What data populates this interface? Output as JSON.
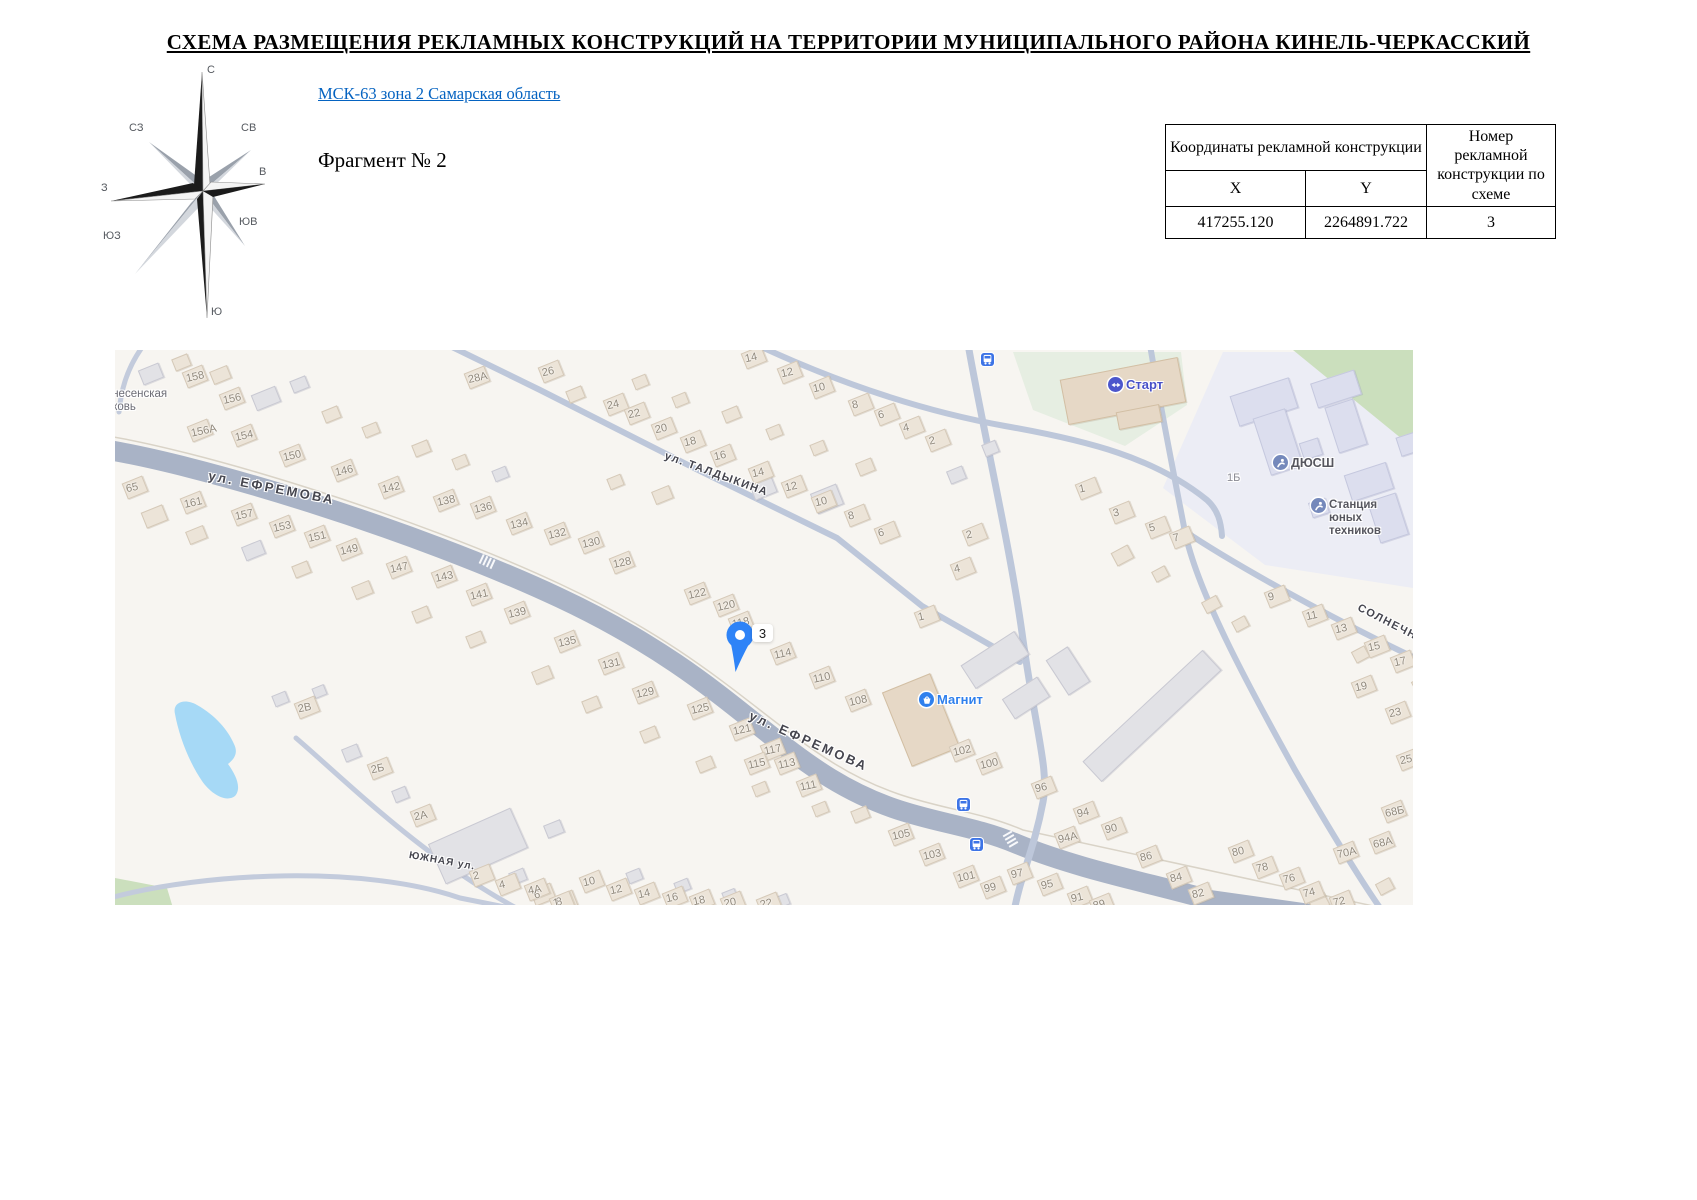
{
  "doc": {
    "title": "СХЕМА РАЗМЕЩЕНИЯ РЕКЛАМНЫХ КОНСТРУКЦИЙ НА ТЕРРИТОРИИ МУНИЦИПАЛЬНОГО РАЙОНА КИНЕЛЬ-ЧЕРКАССКИЙ",
    "link_label": "МСК-63 зона 2 Самарская область",
    "fragment_label": "Фрагмент № 2"
  },
  "compass": {
    "n": "С",
    "ne": "СВ",
    "e": "В",
    "se": "ЮВ",
    "s": "Ю",
    "sw": "ЮЗ",
    "w": "З",
    "nw": "СЗ"
  },
  "table": {
    "coords_header": "Координаты рекламной конструкции",
    "col_x": "X",
    "col_y": "Y",
    "number_header": "Номер рекламной конструкции по схеме",
    "x_value": "417255.120",
    "y_value": "2264891.722",
    "number_value": "3"
  },
  "map": {
    "marker": {
      "label": "3"
    },
    "colors": {
      "road_main": "#a9b3c6",
      "road_minor": "#bdc7da",
      "water": "#a6d9f6",
      "green": "#cbdfbd",
      "lawn": "#e6eee2",
      "campus": "#ecedf5",
      "accent_blue": "#2e83f7"
    },
    "areas": [
      {
        "name": "school-campus-area",
        "path": "M1048,138 L1108,2 L1298,2 L1298,238 L1150,215 Z",
        "color": "#ecedf5"
      },
      {
        "name": "forest-area",
        "path": "M1178,0 L1298,0 L1298,98 Z",
        "color": "#cbdfbd"
      },
      {
        "name": "stadium-lawn",
        "path": "M898,2 L1066,2 L1072,55 L1010,96 L918,60 Z",
        "color": "#e6eee2"
      },
      {
        "name": "green-corner",
        "path": "M0,528 L52,538 L58,558 L0,558 Z",
        "color": "#cbdfbd"
      },
      {
        "name": "pond",
        "path": "M60,364 C57,352 70,348 82,355 C100,365 113,380 119,394 C124,404 118,410 113,414 C121,425 127,438 120,446 C111,453 96,444 87,431 C74,412 64,386 60,364 Z",
        "color": "#a6d9f6"
      }
    ],
    "roads": [
      {
        "name": "field-line-north",
        "path": "M-20,84 C80,98 300,166 445,234 C590,302 645,368 720,414 C795,460 848,454 908,480 L1295,564",
        "width": 1.5,
        "color": "#d9d3c7"
      },
      {
        "name": "ul-efremova-road",
        "path": "M-20,98 C80,112 300,180 445,248 C590,316 640,382 715,428 C790,474 840,468 902,494 C965,520 1040,534 1095,550 L1295,578",
        "width": 20,
        "color": "#a9b3c6"
      },
      {
        "name": "ul-taldykina-road",
        "path": "M335,-4 L425,40 L585,121 L722,188 L807,256 L905,312",
        "width": 6,
        "color": "#bdc7da"
      },
      {
        "name": "north-vertical-road",
        "path": "M853,-6 C868,80 896,200 908,290 C922,388 934,420 928,452 C919,500 905,527 899,562",
        "width": 7,
        "color": "#bdc7da"
      },
      {
        "name": "stadium-loop-road",
        "path": "M640,-6 C700,22 790,58 890,76 C975,91 1040,108 1092,150 C1103,160 1106,172 1107,186",
        "width": 6,
        "color": "#bdc7da"
      },
      {
        "name": "east-vertical-road",
        "path": "M1035,-5 C1046,60 1060,130 1070,182 C1082,240 1130,330 1180,420 C1215,480 1245,530 1268,562",
        "width": 6,
        "color": "#bdc7da"
      },
      {
        "name": "solnechnaya-road",
        "path": "M1068,180 C1120,215 1220,270 1300,308",
        "width": 6,
        "color": "#bdc7da"
      },
      {
        "name": "yuzhnaya-road-1",
        "path": "M181,388 C230,430 310,510 405,560",
        "width": 5,
        "color": "#c3cbdc"
      },
      {
        "name": "yuzhnaya-road-2",
        "path": "M-5,548 C90,522 250,515 345,548 L405,560",
        "width": 5,
        "color": "#c3cbdc"
      },
      {
        "name": "corner-road",
        "path": "M28,-4 C12,18 6,40 4,62",
        "width": 5,
        "color": "#c3cbdc"
      }
    ],
    "crossings": [
      {
        "x": 896,
        "y": 490,
        "rot": 60
      },
      {
        "x": 373,
        "y": 212,
        "rot": 25
      }
    ],
    "streets": [
      {
        "label": "ул. ЕФРЕМОВА",
        "x": 95,
        "y": 118,
        "rot": 11,
        "size": 13,
        "ls": 2.5
      },
      {
        "label": "ул. ЕФРЕМОВА",
        "x": 638,
        "y": 358,
        "rot": 24,
        "size": 13,
        "ls": 2.5
      },
      {
        "label": "ул. ТАЛДЫКИНА",
        "x": 552,
        "y": 100,
        "rot": 20,
        "size": 11,
        "ls": 1.5
      },
      {
        "label": "СОЛНЕЧНАЯ ул.",
        "x": 1246,
        "y": 252,
        "rot": 27,
        "size": 11,
        "ls": 1.5
      },
      {
        "label": "ЮЖНАЯ ул.",
        "x": 295,
        "y": 500,
        "rot": 10,
        "size": 10,
        "ls": 1
      }
    ],
    "pois": [
      {
        "type": "plain",
        "label": "Вознесенская\nцерковь",
        "x": -22,
        "y": 38,
        "color": "#6d6d76",
        "size": 11.5
      },
      {
        "type": "start",
        "label": "Старт",
        "x": 993,
        "y": 27,
        "color": "#4750c8",
        "size": 13
      },
      {
        "type": "sport",
        "label": "ДЮСШ",
        "x": 1158,
        "y": 105,
        "color": "#56565e",
        "size": 12.5
      },
      {
        "type": "sport",
        "label": "Станция юных\nтехников",
        "x": 1196,
        "y": 148,
        "color": "#56565e",
        "size": 11.5
      },
      {
        "type": "magnit",
        "label": "Магнит",
        "x": 804,
        "y": 342,
        "color": "#2f80ed",
        "size": 13
      },
      {
        "type": "plain",
        "label": "1Б",
        "x": 1112,
        "y": 122,
        "color": "#8b8b93",
        "size": 11
      }
    ],
    "bus_stops": [
      [
        866,
        3
      ],
      [
        842,
        448
      ],
      [
        855,
        488
      ]
    ],
    "house_numbers": [
      [
        "158",
        71,
        27
      ],
      [
        "156",
        108,
        49
      ],
      [
        "156А",
        76,
        81
      ],
      [
        "154",
        120,
        86
      ],
      [
        "150",
        168,
        106
      ],
      [
        "146",
        220,
        121
      ],
      [
        "142",
        267,
        138
      ],
      [
        "138",
        322,
        151
      ],
      [
        "136",
        359,
        158
      ],
      [
        "134",
        395,
        174
      ],
      [
        "132",
        433,
        184
      ],
      [
        "130",
        467,
        193
      ],
      [
        "128",
        498,
        213
      ],
      [
        "122",
        573,
        244
      ],
      [
        "120",
        602,
        256
      ],
      [
        "118",
        617,
        273
      ],
      [
        "114",
        659,
        304
      ],
      [
        "110",
        698,
        328
      ],
      [
        "108",
        734,
        351
      ],
      [
        "102",
        838,
        401
      ],
      [
        "100",
        865,
        414
      ],
      [
        "96",
        920,
        438
      ],
      [
        "94",
        962,
        463
      ],
      [
        "90",
        990,
        479
      ],
      [
        "94А",
        943,
        488
      ],
      [
        "86",
        1025,
        507
      ],
      [
        "84",
        1055,
        528
      ],
      [
        "82",
        1077,
        544
      ],
      [
        "28А",
        353,
        28
      ],
      [
        "26",
        427,
        22
      ],
      [
        "65",
        11,
        138
      ],
      [
        "161",
        69,
        153
      ],
      [
        "157",
        120,
        165
      ],
      [
        "153",
        158,
        177
      ],
      [
        "151",
        193,
        187
      ],
      [
        "149",
        225,
        200
      ],
      [
        "147",
        275,
        218
      ],
      [
        "143",
        320,
        227
      ],
      [
        "141",
        355,
        245
      ],
      [
        "139",
        393,
        263
      ],
      [
        "135",
        443,
        292
      ],
      [
        "131",
        487,
        314
      ],
      [
        "129",
        521,
        343
      ],
      [
        "125",
        576,
        359
      ],
      [
        "121",
        618,
        380
      ],
      [
        "117",
        649,
        400
      ],
      [
        "115",
        633,
        414
      ],
      [
        "113",
        663,
        414
      ],
      [
        "111",
        685,
        436
      ],
      [
        "105",
        777,
        485
      ],
      [
        "103",
        808,
        505
      ],
      [
        "101",
        842,
        527
      ],
      [
        "99",
        869,
        538
      ],
      [
        "97",
        896,
        524
      ],
      [
        "95",
        926,
        535
      ],
      [
        "91",
        956,
        548
      ],
      [
        "89",
        978,
        555
      ],
      [
        "24",
        492,
        55
      ],
      [
        "22",
        513,
        64
      ],
      [
        "20",
        540,
        79
      ],
      [
        "18",
        569,
        92
      ],
      [
        "16",
        599,
        106
      ],
      [
        "14",
        630,
        8
      ],
      [
        "12",
        666,
        23
      ],
      [
        "10",
        698,
        38
      ],
      [
        "8",
        737,
        55
      ],
      [
        "6",
        763,
        65
      ],
      [
        "4",
        788,
        78
      ],
      [
        "2",
        814,
        91
      ],
      [
        "14",
        637,
        123
      ],
      [
        "12",
        670,
        137
      ],
      [
        "10",
        700,
        152
      ],
      [
        "8",
        733,
        166
      ],
      [
        "6",
        763,
        183
      ],
      [
        "2",
        851,
        185
      ],
      [
        "4",
        839,
        219
      ],
      [
        "1",
        803,
        267
      ],
      [
        "1",
        964,
        139
      ],
      [
        "3",
        998,
        163
      ],
      [
        "5",
        1034,
        178
      ],
      [
        "7",
        1058,
        188
      ],
      [
        "9",
        1153,
        247
      ],
      [
        "11",
        1191,
        266
      ],
      [
        "13",
        1220,
        279
      ],
      [
        "15",
        1253,
        297
      ],
      [
        "17",
        1279,
        312
      ],
      [
        "19",
        1240,
        337
      ],
      [
        "23",
        1274,
        363
      ],
      [
        "25",
        1285,
        410
      ],
      [
        "68Б",
        1270,
        462
      ],
      [
        "68А",
        1258,
        493
      ],
      [
        "70А",
        1222,
        503
      ],
      [
        "80",
        1117,
        502
      ],
      [
        "78",
        1141,
        518
      ],
      [
        "76",
        1168,
        529
      ],
      [
        "74",
        1188,
        543
      ],
      [
        "72",
        1218,
        552
      ],
      [
        "2В",
        183,
        358
      ],
      [
        "2Б",
        256,
        419
      ],
      [
        "2А",
        299,
        466
      ],
      [
        "2",
        358,
        526
      ],
      [
        "4",
        384,
        535
      ],
      [
        "6",
        419,
        545
      ],
      [
        "8",
        441,
        552
      ],
      [
        "4А",
        413,
        540
      ],
      [
        "1",
        438,
        553
      ],
      [
        "10",
        468,
        532
      ],
      [
        "12",
        495,
        540
      ],
      [
        "14",
        523,
        544
      ],
      [
        "16",
        551,
        548
      ],
      [
        "18",
        578,
        551
      ],
      [
        "20",
        609,
        553
      ],
      [
        "22",
        645,
        554
      ]
    ],
    "big_buildings": [
      [
        948,
        18,
        118,
        44,
        -11,
        "t"
      ],
      [
        1002,
        58,
        42,
        16,
        -11,
        "t"
      ],
      [
        780,
        330,
        50,
        78,
        -22,
        "t"
      ],
      [
        955,
        352,
        162,
        26,
        -43,
        "g"
      ],
      [
        318,
        474,
        88,
        42,
        -24,
        "g"
      ],
      [
        848,
        296,
        62,
        26,
        -33,
        "g"
      ],
      [
        890,
        336,
        40,
        22,
        -33,
        "g"
      ],
      [
        940,
        300,
        24,
        40,
        -33,
        "g"
      ]
    ],
    "campus_buildings": [
      [
        1118,
        36,
        60,
        30,
        -18
      ],
      [
        1146,
        62,
        32,
        58,
        -18
      ],
      [
        1198,
        26,
        44,
        24,
        -18
      ],
      [
        1216,
        52,
        28,
        46,
        -18
      ],
      [
        1232,
        118,
        42,
        26,
        -18
      ],
      [
        1258,
        146,
        28,
        42,
        -18
      ],
      [
        1186,
        90,
        18,
        16,
        -18
      ],
      [
        1283,
        84,
        20,
        18,
        -18
      ],
      [
        1195,
        150,
        16,
        14,
        -18
      ]
    ],
    "filler_houses": [
      [
        25,
        16,
        20,
        14,
        -22,
        "g"
      ],
      [
        58,
        6,
        15,
        11,
        -22,
        "b"
      ],
      [
        96,
        18,
        17,
        12,
        -22,
        "b"
      ],
      [
        138,
        40,
        24,
        15,
        -22,
        "g"
      ],
      [
        176,
        28,
        15,
        11,
        -22,
        "g"
      ],
      [
        208,
        58,
        15,
        11,
        -22,
        "b"
      ],
      [
        248,
        74,
        14,
        10,
        -22,
        "b"
      ],
      [
        298,
        92,
        15,
        11,
        -22,
        "b"
      ],
      [
        338,
        106,
        13,
        10,
        -22,
        "b"
      ],
      [
        378,
        118,
        13,
        10,
        -22,
        "g"
      ],
      [
        452,
        38,
        15,
        11,
        -22,
        "b"
      ],
      [
        518,
        26,
        13,
        10,
        -22,
        "b"
      ],
      [
        558,
        44,
        13,
        10,
        -22,
        "b"
      ],
      [
        608,
        58,
        15,
        11,
        -22,
        "b"
      ],
      [
        652,
        76,
        13,
        10,
        -22,
        "b"
      ],
      [
        696,
        92,
        13,
        10,
        -22,
        "b"
      ],
      [
        742,
        110,
        15,
        12,
        -22,
        "b"
      ],
      [
        636,
        128,
        22,
        17,
        -22,
        "g"
      ],
      [
        698,
        138,
        26,
        20,
        -22,
        "g"
      ],
      [
        538,
        138,
        17,
        12,
        -22,
        "b"
      ],
      [
        493,
        126,
        13,
        10,
        -22,
        "b"
      ],
      [
        833,
        118,
        15,
        12,
        -22,
        "g"
      ],
      [
        868,
        92,
        13,
        11,
        -22,
        "g"
      ],
      [
        28,
        158,
        21,
        15,
        -22,
        "b"
      ],
      [
        72,
        178,
        17,
        12,
        -22,
        "b"
      ],
      [
        128,
        193,
        19,
        13,
        -22,
        "g"
      ],
      [
        178,
        213,
        15,
        11,
        -22,
        "b"
      ],
      [
        238,
        233,
        17,
        12,
        -22,
        "b"
      ],
      [
        298,
        258,
        15,
        11,
        -22,
        "b"
      ],
      [
        352,
        283,
        15,
        11,
        -22,
        "b"
      ],
      [
        418,
        318,
        17,
        12,
        -22,
        "b"
      ],
      [
        468,
        348,
        15,
        11,
        -22,
        "b"
      ],
      [
        526,
        378,
        15,
        11,
        -22,
        "b"
      ],
      [
        582,
        408,
        15,
        11,
        -22,
        "b"
      ],
      [
        638,
        433,
        13,
        10,
        -22,
        "b"
      ],
      [
        737,
        458,
        15,
        11,
        -22,
        "b"
      ],
      [
        698,
        453,
        13,
        10,
        -22,
        "b"
      ],
      [
        998,
        198,
        17,
        13,
        -28,
        "b"
      ],
      [
        1038,
        218,
        13,
        10,
        -28,
        "b"
      ],
      [
        1088,
        248,
        15,
        11,
        -28,
        "b"
      ],
      [
        1118,
        268,
        13,
        10,
        -28,
        "b"
      ],
      [
        1298,
        328,
        13,
        11,
        -28,
        "b"
      ],
      [
        1238,
        298,
        13,
        11,
        -28,
        "b"
      ],
      [
        158,
        343,
        13,
        10,
        -22,
        "g"
      ],
      [
        198,
        336,
        11,
        9,
        -22,
        "g"
      ],
      [
        228,
        396,
        15,
        12,
        -22,
        "g"
      ],
      [
        278,
        438,
        13,
        11,
        -22,
        "g"
      ],
      [
        395,
        520,
        14,
        11,
        -22,
        "g"
      ],
      [
        430,
        472,
        16,
        12,
        -22,
        "g"
      ],
      [
        512,
        520,
        13,
        10,
        -22,
        "g"
      ],
      [
        560,
        530,
        13,
        10,
        -22,
        "g"
      ],
      [
        608,
        540,
        12,
        10,
        -22,
        "g"
      ],
      [
        660,
        545,
        12,
        10,
        -22,
        "g"
      ],
      [
        1195,
        545,
        16,
        13,
        -28,
        "b"
      ],
      [
        1262,
        530,
        14,
        11,
        -28,
        "b"
      ]
    ]
  }
}
